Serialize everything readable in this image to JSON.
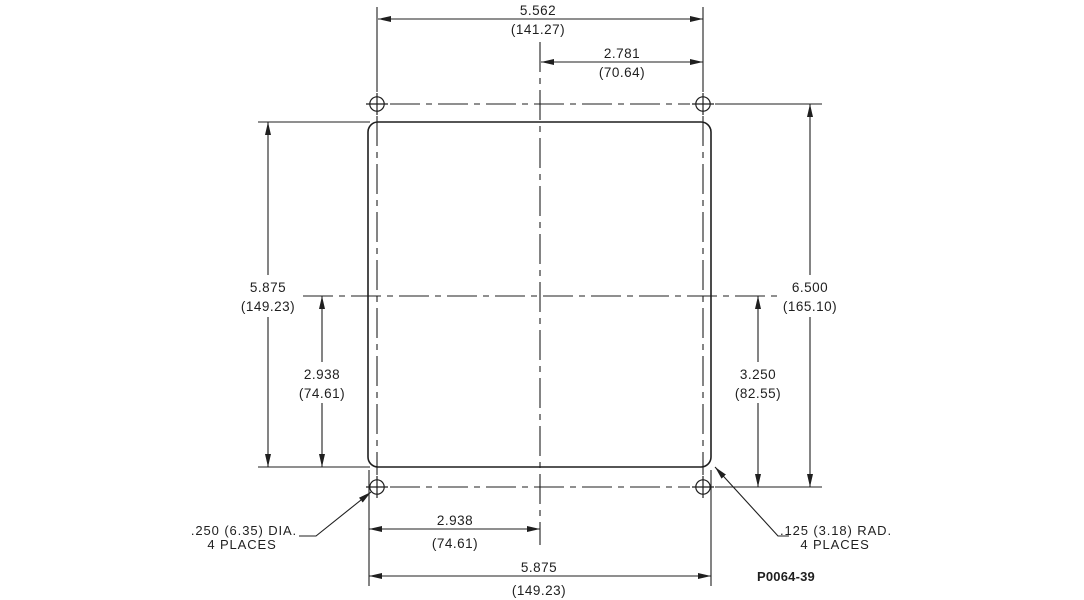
{
  "drawing": {
    "title": "panel-mounting-dimension-drawing",
    "part_number": "P0064-39",
    "colors": {
      "line": "#1f1f1f",
      "background": "#ffffff"
    },
    "dims": {
      "hole_span_width": {
        "in": "5.562",
        "mm": "(141.27)"
      },
      "hole_half_width": {
        "in": "2.781",
        "mm": "(70.64)"
      },
      "panel_height": {
        "in": "5.875",
        "mm": "(149.23)"
      },
      "panel_half_height": {
        "in": "2.938",
        "mm": "(74.61)"
      },
      "hole_span_height": {
        "in": "6.500",
        "mm": "(165.10)"
      },
      "hole_half_height": {
        "in": "3.250",
        "mm": "(82.55)"
      },
      "panel_half_width": {
        "in": "2.938",
        "mm": "(74.61)"
      },
      "panel_width": {
        "in": "5.875",
        "mm": "(149.23)"
      }
    },
    "notes": {
      "hole_diameter": {
        "line1": ".250 (6.35) DIA.",
        "line2": "4 PLACES"
      },
      "corner_radius": {
        "line1": ".125 (3.18) RAD.",
        "line2": "4 PLACES"
      }
    }
  }
}
